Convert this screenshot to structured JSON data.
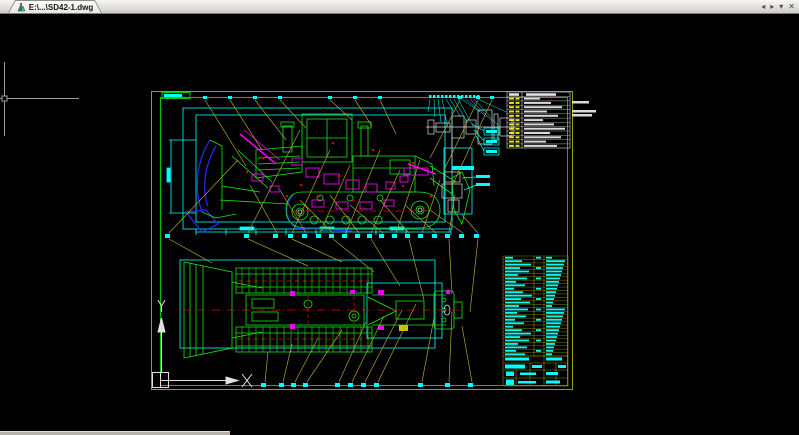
{
  "window": {
    "tab_label": "E:\\...\\SD42-1.dwg",
    "tab_controls": [
      "◂",
      "▸",
      "▾",
      "✕"
    ]
  },
  "drawing": {
    "colors": {
      "leader": "#b3a233",
      "dim": "#00ffff",
      "green": "#17e817",
      "green_dim": "#00c400",
      "sheet_outer": "#9c9c00",
      "magenta": "#f000f0",
      "blue": "#2a2aff",
      "red": "#e00000",
      "white": "#d9d9d9",
      "grid_yellow": "#8f8f00"
    },
    "balloons_mid": {
      "y": 234,
      "xs": [
        167,
        246,
        275,
        290,
        304,
        318,
        331,
        344,
        357,
        369,
        381,
        394,
        407,
        420,
        434,
        447,
        461,
        476
      ]
    },
    "labels_bottom": {
      "y": 383,
      "xs": [
        263,
        281,
        293,
        305,
        337,
        350,
        363,
        376,
        420,
        447,
        470
      ]
    },
    "anchors_top": {
      "y": 96,
      "xs": [
        205,
        230,
        255,
        280,
        330,
        355,
        380,
        460,
        478,
        492
      ]
    },
    "detail_ticks": {
      "y": 95,
      "x0": 430,
      "step": 4,
      "count": 13
    },
    "leaders_yellow": [
      [
        169,
        233,
        238,
        160
      ],
      [
        248,
        233,
        300,
        130
      ],
      [
        277,
        233,
        250,
        185
      ],
      [
        292,
        233,
        330,
        150
      ],
      [
        306,
        233,
        280,
        190
      ],
      [
        320,
        233,
        350,
        165
      ],
      [
        333,
        233,
        300,
        200
      ],
      [
        346,
        233,
        380,
        150
      ],
      [
        359,
        233,
        330,
        195
      ],
      [
        371,
        233,
        400,
        170
      ],
      [
        383,
        233,
        350,
        205
      ],
      [
        396,
        233,
        420,
        160
      ],
      [
        409,
        233,
        380,
        200
      ],
      [
        422,
        233,
        440,
        180
      ],
      [
        436,
        233,
        405,
        205
      ],
      [
        449,
        233,
        455,
        195
      ],
      [
        463,
        233,
        430,
        210
      ],
      [
        478,
        233,
        462,
        215
      ],
      [
        248,
        239,
        308,
        266
      ],
      [
        292,
        239,
        342,
        262
      ],
      [
        333,
        239,
        374,
        272
      ],
      [
        371,
        239,
        400,
        286
      ],
      [
        409,
        239,
        424,
        300
      ],
      [
        449,
        239,
        452,
        294
      ],
      [
        478,
        239,
        470,
        312
      ],
      [
        169,
        239,
        212,
        263
      ],
      [
        205,
        100,
        246,
        166
      ],
      [
        230,
        100,
        262,
        150
      ],
      [
        255,
        100,
        286,
        140
      ],
      [
        280,
        100,
        306,
        128
      ],
      [
        330,
        100,
        352,
        120
      ],
      [
        355,
        100,
        372,
        126
      ],
      [
        380,
        100,
        396,
        134
      ],
      [
        460,
        100,
        430,
        158
      ],
      [
        478,
        100,
        444,
        170
      ],
      [
        492,
        100,
        452,
        186
      ],
      [
        265,
        382,
        268,
        352
      ],
      [
        283,
        382,
        292,
        344
      ],
      [
        295,
        382,
        318,
        338
      ],
      [
        307,
        382,
        342,
        330
      ],
      [
        339,
        382,
        366,
        322
      ],
      [
        352,
        382,
        384,
        316
      ],
      [
        365,
        382,
        402,
        310
      ],
      [
        378,
        382,
        416,
        304
      ],
      [
        422,
        382,
        434,
        318
      ],
      [
        449,
        382,
        452,
        312
      ],
      [
        472,
        382,
        462,
        326
      ]
    ],
    "magenta_rects_side": [
      [
        292,
        158,
        10,
        7
      ],
      [
        306,
        168,
        13,
        9
      ],
      [
        324,
        174,
        15,
        10
      ],
      [
        346,
        180,
        13,
        9
      ],
      [
        366,
        184,
        11,
        8
      ],
      [
        386,
        182,
        9,
        7
      ],
      [
        252,
        174,
        11,
        7
      ],
      [
        270,
        186,
        9,
        6
      ],
      [
        400,
        176,
        8,
        6
      ],
      [
        312,
        200,
        12,
        7
      ],
      [
        336,
        202,
        12,
        7
      ],
      [
        360,
        202,
        12,
        7
      ],
      [
        384,
        200,
        10,
        6
      ],
      [
        404,
        168,
        24,
        7
      ]
    ],
    "magenta_rects_top": [
      [
        290,
        291,
        5,
        5
      ],
      [
        290,
        324,
        5,
        5
      ],
      [
        378,
        290,
        6,
        5
      ],
      [
        378,
        325,
        6,
        5
      ],
      [
        350,
        290,
        5,
        4
      ],
      [
        446,
        290,
        4,
        4
      ]
    ],
    "red_markers": [
      [
        262,
        157
      ],
      [
        300,
        184
      ],
      [
        318,
        195
      ],
      [
        352,
        199
      ],
      [
        372,
        149
      ],
      [
        402,
        185
      ],
      [
        430,
        195
      ],
      [
        246,
        171
      ],
      [
        286,
        195
      ],
      [
        338,
        175
      ],
      [
        412,
        162
      ],
      [
        332,
        142
      ]
    ],
    "track_rungs": {
      "x0": 242,
      "x1": 368,
      "step": 7,
      "top": [
        268,
        293
      ],
      "bot": [
        327,
        352
      ]
    },
    "param_table": {
      "x": 507,
      "y": 92,
      "w": 63,
      "h": 56,
      "rows": 12,
      "row_h": 4.3,
      "overflow_bars": [
        [
          572,
          101,
          17,
          2.5
        ],
        [
          572,
          110,
          24,
          2.5
        ],
        [
          572,
          114,
          20,
          2.5
        ]
      ]
    },
    "bom_table": {
      "x": 503,
      "y": 256,
      "w": 65,
      "rows": 29,
      "row_h": 3.45
    }
  }
}
